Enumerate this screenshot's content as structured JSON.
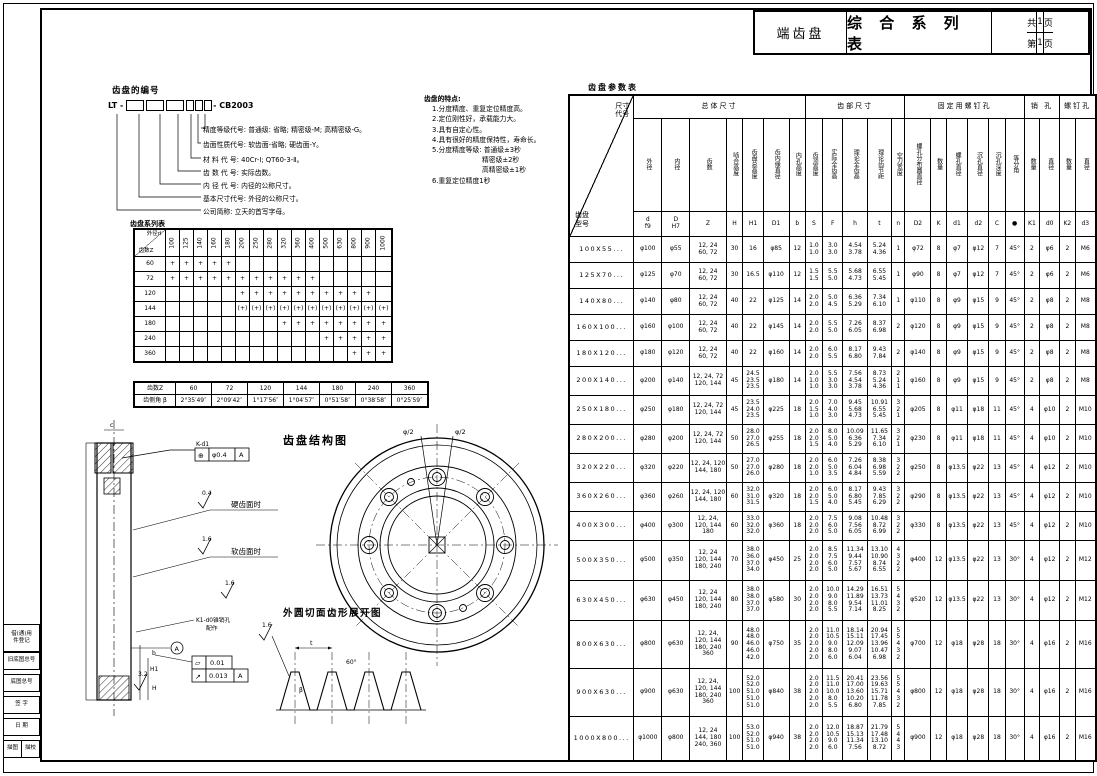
{
  "title_block": {
    "product": "端齿盘",
    "series_title": "综 合 系 列 表",
    "total_label": "共",
    "total_num": "1",
    "total_unit": "页",
    "page_label": "第",
    "page_num": "1",
    "page_unit": "页"
  },
  "numbering": {
    "heading": "齿盘的编号",
    "code_prefix": "LT -",
    "code_suffix": "- CB2003",
    "items": [
      "精度等级代号: 普通级: 省略; 精密级-M; 高精密级-G。",
      "齿面性质代号: 软齿面-省略; 硬齿面-Y。",
      "材 料 代 号: 40Cr-Ⅰ; QT60-3-Ⅱ。",
      "齿 数 代 号: 实际齿数。",
      "内 径 代 号: 内径的公称尺寸。",
      "基本尺寸代号: 外径的公称尺寸。",
      "公司简称: 立天的首写字母。"
    ]
  },
  "features": {
    "heading": "齿盘的特点:",
    "items": [
      {
        "text": "1.分度精度、重复定位精度高。",
        "indent": 0
      },
      {
        "text": "2.定位刚性好，承载能力大。",
        "indent": 0
      },
      {
        "text": "3.具有自定心性。",
        "indent": 0
      },
      {
        "text": "4.具有很好的精度保持性，寿命长。",
        "indent": 0
      },
      {
        "text": "5.分度精度等级: 普通级±3秒",
        "indent": 0
      },
      {
        "text": "精密级±2秒",
        "indent": 1
      },
      {
        "text": "高精密级±1秒",
        "indent": 1
      },
      {
        "text": "6.重复定位精度1秒",
        "indent": 0
      }
    ]
  },
  "series_table": {
    "caption": "齿盘系列表",
    "corner_top": "外径d",
    "corner_bottom": "齿数Z",
    "columns": [
      "100",
      "125",
      "140",
      "160",
      "180",
      "200",
      "250",
      "280",
      "320",
      "360",
      "400",
      "500",
      "630",
      "800",
      "900",
      "1000"
    ],
    "rows": [
      {
        "z": "60",
        "marks": [
          "+",
          "+",
          "+",
          "+",
          "+",
          "",
          "",
          "",
          "",
          "",
          "",
          "",
          "",
          "",
          "",
          ""
        ]
      },
      {
        "z": "72",
        "marks": [
          "+",
          "+",
          "+",
          "+",
          "+",
          "+",
          "+",
          "+",
          "+",
          "+",
          "+",
          "",
          "",
          "",
          "",
          ""
        ]
      },
      {
        "z": "120",
        "marks": [
          "",
          "",
          "",
          "",
          "",
          "+",
          "+",
          "+",
          "+",
          "+",
          "+",
          "+",
          "+",
          "+",
          "+",
          ""
        ]
      },
      {
        "z": "144",
        "marks": [
          "",
          "",
          "",
          "",
          "",
          "(+)",
          "(+)",
          "(+)",
          "(+)",
          "(+)",
          "(+)",
          "(+)",
          "(+)",
          "(+)",
          "(+)",
          "(+)"
        ]
      },
      {
        "z": "180",
        "marks": [
          "",
          "",
          "",
          "",
          "",
          "",
          "",
          "",
          "+",
          "+",
          "+",
          "+",
          "+",
          "+",
          "+",
          "+"
        ]
      },
      {
        "z": "240",
        "marks": [
          "",
          "",
          "",
          "",
          "",
          "",
          "",
          "",
          "",
          "",
          "",
          "+",
          "+",
          "+",
          "+",
          "+"
        ]
      },
      {
        "z": "360",
        "marks": [
          "",
          "",
          "",
          "",
          "",
          "",
          "",
          "",
          "",
          "",
          "",
          "",
          "",
          "+",
          "+",
          "+"
        ]
      }
    ]
  },
  "tooth_angle_table": {
    "row1_label": "齿数Z",
    "row2_label": "齿侧角 β",
    "columns": [
      "60",
      "72",
      "120",
      "144",
      "180",
      "240",
      "360"
    ],
    "angles": [
      "2°35′49″",
      "2°09′42″",
      "1°17′56″",
      "1°04′57″",
      "0°51′58″",
      "0°38′58″",
      "0°25′59″"
    ]
  },
  "params_table": {
    "caption": "齿盘参数表",
    "corner_top": "尺寸代号",
    "corner_bottom": "齿盘型号",
    "groups": [
      {
        "label": "总体尺寸",
        "span": 7
      },
      {
        "label": "齿部尺寸",
        "span": 5
      },
      {
        "label": "固定用螺钉孔",
        "span": 6
      },
      {
        "label": "销 孔",
        "span": 2
      },
      {
        "label": "螺钉孔",
        "span": 2
      }
    ],
    "col_labels": [
      "外径",
      "内径",
      "齿数",
      "啮合高度",
      "齿盘总高度",
      "齿内缘直径",
      "内孔高度",
      "齿顶高度",
      "实际全齿高",
      "理论全齿高",
      "理论齿节距",
      "空刀宽度",
      "螺孔分布圆直径",
      "数量",
      "螺孔直径",
      "沉孔直径",
      "沉孔深度",
      "等分角",
      "数量",
      "直径",
      "数量",
      "直径"
    ],
    "col_codes": [
      "d\nf9",
      "D\nH7",
      "Z",
      "H",
      "H1",
      "D1",
      "b",
      "S",
      "F",
      "h",
      "t",
      "n",
      "D2",
      "K",
      "d1",
      "d2",
      "C",
      "●",
      "K1",
      "d0",
      "K2",
      "d3"
    ],
    "rows": [
      [
        "100X55...",
        "φ100",
        "φ55",
        "12, 24\n60, 72",
        "30",
        "16",
        "φ85",
        "12",
        "1.0\n1.0",
        "3.0\n3.0",
        "4.54\n3.78",
        "5.24\n4.36",
        "1",
        "φ72",
        "8",
        "φ7",
        "φ12",
        "7",
        "45°",
        "2",
        "φ6",
        "2",
        "M6"
      ],
      [
        "125X70...",
        "φ125",
        "φ70",
        "12, 24\n60, 72",
        "30",
        "16.5",
        "φ110",
        "12",
        "1.5\n1.5",
        "5.5\n5.0",
        "5.68\n4.73",
        "6.55\n5.45",
        "1",
        "φ90",
        "8",
        "φ7",
        "φ12",
        "7",
        "45°",
        "2",
        "φ6",
        "2",
        "M6"
      ],
      [
        "140X80...",
        "φ140",
        "φ80",
        "12, 24\n60, 72",
        "40",
        "22",
        "φ125",
        "14",
        "2.0\n2.0",
        "5.0\n4.5",
        "6.36\n5.29",
        "7.34\n6.10",
        "1",
        "φ110",
        "8",
        "φ9",
        "φ15",
        "9",
        "45°",
        "2",
        "φ8",
        "2",
        "M8"
      ],
      [
        "160X100...",
        "φ160",
        "φ100",
        "12, 24\n60, 72",
        "40",
        "22",
        "φ145",
        "14",
        "2.0\n2.0",
        "5.5\n5.0",
        "7.26\n6.05",
        "8.37\n6.98",
        "2",
        "φ120",
        "8",
        "φ9",
        "φ15",
        "9",
        "45°",
        "2",
        "φ8",
        "2",
        "M8"
      ],
      [
        "180X120...",
        "φ180",
        "φ120",
        "12, 24\n60, 72",
        "40",
        "22",
        "φ160",
        "14",
        "2.0\n2.0",
        "6.0\n5.5",
        "8.17\n6.80",
        "9.43\n7.84",
        "2",
        "φ140",
        "8",
        "φ9",
        "φ15",
        "9",
        "45°",
        "2",
        "φ8",
        "2",
        "M8"
      ],
      [
        "200X140...",
        "φ200",
        "φ140",
        "12, 24, 72\n120, 144",
        "45",
        "24.5\n23.5\n23.5",
        "φ180",
        "14",
        "2.0\n1.0\n1.0",
        "5.5\n3.0\n3.0",
        "7.56\n4.54\n3.78",
        "8.73\n5.24\n4.36",
        "2\n1\n1",
        "φ160",
        "8",
        "φ9",
        "φ15",
        "9",
        "45°",
        "2",
        "φ8",
        "2",
        "M8"
      ],
      [
        "250X180...",
        "φ250",
        "φ180",
        "12, 24, 72\n120, 144",
        "45",
        "23.5\n24.0\n23.5",
        "φ225",
        "18",
        "2.0\n1.5\n1.0",
        "7.0\n4.0\n3.0",
        "9.45\n5.68\n4.73",
        "10.91\n6.55\n5.45",
        "3\n2\n1",
        "φ205",
        "8",
        "φ11",
        "φ18",
        "11",
        "45°",
        "4",
        "φ10",
        "2",
        "M10"
      ],
      [
        "280X200...",
        "φ280",
        "φ200",
        "12, 24, 72\n120, 144",
        "50",
        "28.0\n27.0\n26.5",
        "φ255",
        "18",
        "2.0\n2.0\n1.5",
        "8.0\n5.0\n4.0",
        "10.09\n6.36\n5.29",
        "11.65\n7.34\n6.10",
        "3\n2\n1",
        "φ230",
        "8",
        "φ11",
        "φ18",
        "11",
        "45°",
        "4",
        "φ10",
        "2",
        "M10"
      ],
      [
        "320X220...",
        "φ320",
        "φ220",
        "12, 24, 120\n144, 180",
        "50",
        "27.0\n27.0\n26.0",
        "φ280",
        "18",
        "2.0\n2.0\n1.0",
        "6.0\n5.0\n3.5",
        "7.26\n6.04\n4.84",
        "8.38\n6.98\n5.59",
        "3\n2\n2",
        "φ250",
        "8",
        "φ13.5",
        "φ22",
        "13",
        "45°",
        "4",
        "φ12",
        "2",
        "M10"
      ],
      [
        "360X260...",
        "φ360",
        "φ260",
        "12, 24, 120\n144, 180",
        "60",
        "32.0\n31.0\n31.5",
        "φ320",
        "18",
        "2.0\n2.0\n1.5",
        "6.0\n5.0\n4.0",
        "8.17\n6.80\n5.45",
        "9.43\n7.85\n6.29",
        "3\n2\n2",
        "φ290",
        "8",
        "φ13.5",
        "φ22",
        "13",
        "45°",
        "4",
        "φ12",
        "2",
        "M10"
      ],
      [
        "400X300...",
        "φ400",
        "φ300",
        "12, 24,\n120, 144\n180",
        "60",
        "33.0\n32.0\n32.0",
        "φ360",
        "18",
        "2.0\n2.0\n2.0",
        "7.5\n6.0\n5.0",
        "9.08\n7.56\n6.05",
        "10.48\n8.72\n6.99",
        "3\n2\n2",
        "φ330",
        "8",
        "φ13.5",
        "φ22",
        "13",
        "45°",
        "4",
        "φ12",
        "2",
        "M10"
      ],
      [
        "500X350...",
        "φ500",
        "φ350",
        "12, 24\n120, 144\n180, 240",
        "70",
        "38.0\n36.0\n37.0\n34.0",
        "φ450",
        "25",
        "2.0\n2.0\n2.0\n2.0",
        "8.5\n7.5\n6.0\n5.0",
        "11.34\n9.44\n7.57\n5.67",
        "13.10\n10.90\n8.74\n6.55",
        "4\n3\n2\n2",
        "φ400",
        "12",
        "φ13.5",
        "φ22",
        "13",
        "30°",
        "4",
        "φ12",
        "2",
        "M12"
      ],
      [
        "630X450...",
        "φ630",
        "φ450",
        "12, 24\n120, 144\n180, 240",
        "80",
        "38.0\n38.0\n37.0\n37.0",
        "φ580",
        "30",
        "2.0\n2.0\n2.0\n2.0",
        "10.0\n9.0\n8.0\n5.5",
        "14.29\n11.89\n9.54\n7.14",
        "16.51\n13.73\n11.01\n8.25",
        "5\n4\n3\n2",
        "φ520",
        "12",
        "φ13.5",
        "φ22",
        "13",
        "30°",
        "4",
        "φ12",
        "2",
        "M12"
      ],
      [
        "800X630...",
        "φ800",
        "φ630",
        "12, 24,\n120, 144\n180, 240\n360",
        "90",
        "48.0\n48.0\n46.0\n46.0\n42.0",
        "φ750",
        "35",
        "2.0\n2.0\n2.0\n2.0\n2.0",
        "11.0\n10.5\n9.0\n8.0\n6.0",
        "18.14\n15.11\n12.09\n9.07\n6.04",
        "20.94\n17.45\n13.96\n10.47\n6.98",
        "5\n5\n4\n3\n2",
        "φ700",
        "12",
        "φ18",
        "φ28",
        "18",
        "30°",
        "4",
        "φ16",
        "2",
        "M16"
      ],
      [
        "900X630...",
        "φ900",
        "φ630",
        "12, 24,\n120, 144\n180, 240\n360",
        "100",
        "52.0\n52.0\n51.0\n51.0\n51.0",
        "φ840",
        "38",
        "2.0\n2.0\n2.0\n2.0\n2.0",
        "11.5\n11.0\n10.0\n8.0\n5.5",
        "20.41\n17.00\n13.60\n10.20\n6.80",
        "23.56\n19.63\n15.71\n11.78\n7.85",
        "5\n5\n4\n3\n2",
        "φ800",
        "12",
        "φ18",
        "φ28",
        "18",
        "30°",
        "4",
        "φ16",
        "2",
        "M16"
      ],
      [
        "1000X800...",
        "φ1000",
        "φ800",
        "12, 24\n144, 180\n240, 360",
        "100",
        "53.0\n52.0\n51.0\n51.0",
        "φ940",
        "38",
        "2.0\n2.0\n2.0\n2.0",
        "12.0\n10.5\n9.0\n6.0",
        "18.87\n15.13\n11.34\n7.56",
        "21.79\n17.48\n13.10\n8.72",
        "5\n4\n4\n3",
        "φ900",
        "12",
        "φ18",
        "φ28",
        "18",
        "30°",
        "4",
        "φ16",
        "2",
        "M16"
      ]
    ]
  },
  "drawings": {
    "structure_title": "齿盘结构图",
    "development_title": "外圆切面齿形展开图",
    "half_angle_left": "φ/2",
    "half_angle_right": "φ/2",
    "section": {
      "kd1_label": "K-d1",
      "pos_symbol": "⊕",
      "pos_tol": "φ0.4",
      "pos_datum": "A",
      "rough_hard": "0.4",
      "hard_label": "硬齿面时",
      "rough_soft": "1.6",
      "soft_label": "软齿面时",
      "rough_mid": "1.6",
      "rough_bottom": "3.2",
      "flat_symbol": "▱",
      "flat_tol": "0.01",
      "runout_symbol": "↗",
      "runout_tol": "0.013",
      "runout_datum": "A",
      "datum_label": "A",
      "pin_note_1": "K1-d0锥销孔",
      "pin_note_2": "配作",
      "dim_c": "c",
      "dim_b": "b",
      "dim_h1": "H1",
      "dim_h": "H"
    },
    "development": {
      "dim_t": "t",
      "angle": "60°",
      "beta": "β",
      "rough": "1.6"
    }
  },
  "margin_block": {
    "rows": [
      "借(通)用\n件登记",
      "旧底图总号",
      "底图总号",
      "签  字",
      "日  期"
    ],
    "last_row": [
      "描图",
      "描校"
    ]
  }
}
